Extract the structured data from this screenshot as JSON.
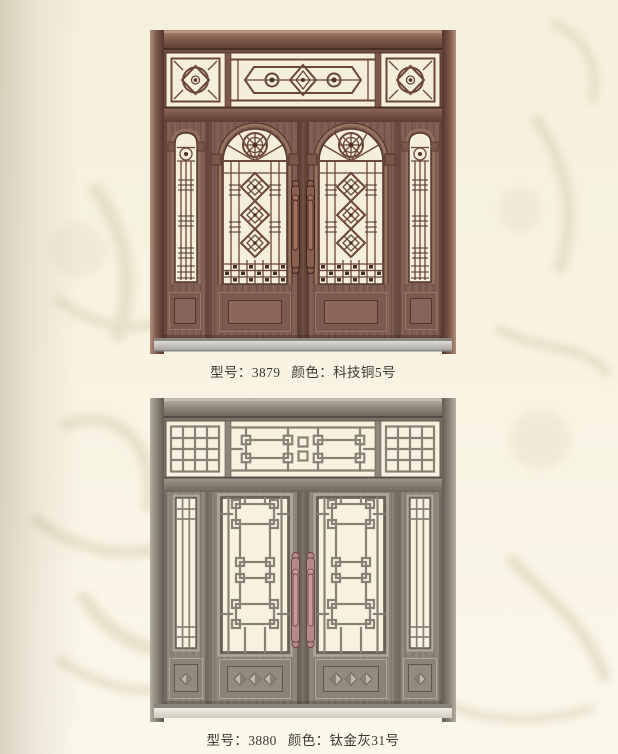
{
  "products": [
    {
      "model_label": "型号：",
      "model": "3879",
      "color_label": "颜色：",
      "color": "科技铜5号",
      "door_name": "copper-double-door-arched-windows"
    },
    {
      "model_label": "型号：",
      "model": "3880",
      "color_label": "颜色：",
      "color": "钛金灰31号",
      "door_name": "titanium-grey-double-door-lattice-windows"
    }
  ],
  "colors": {
    "page_background": "#f7f2e1",
    "watermark": "#ddd4ba",
    "caption_text": "#3e3a33",
    "door1_body": "#7b5a4f",
    "door1_frame_highlight": "#ab8875",
    "door1_frame_dark": "#53352c",
    "door1_glass": "#f4eeda",
    "door2_body": "#8c8378",
    "door2_frame_highlight": "#b7aea2",
    "door2_frame_dark": "#5f574e",
    "door2_glass": "#f7f1df",
    "door2_handle": "#b8898b",
    "threshold_silver": "#b9b7b2"
  }
}
